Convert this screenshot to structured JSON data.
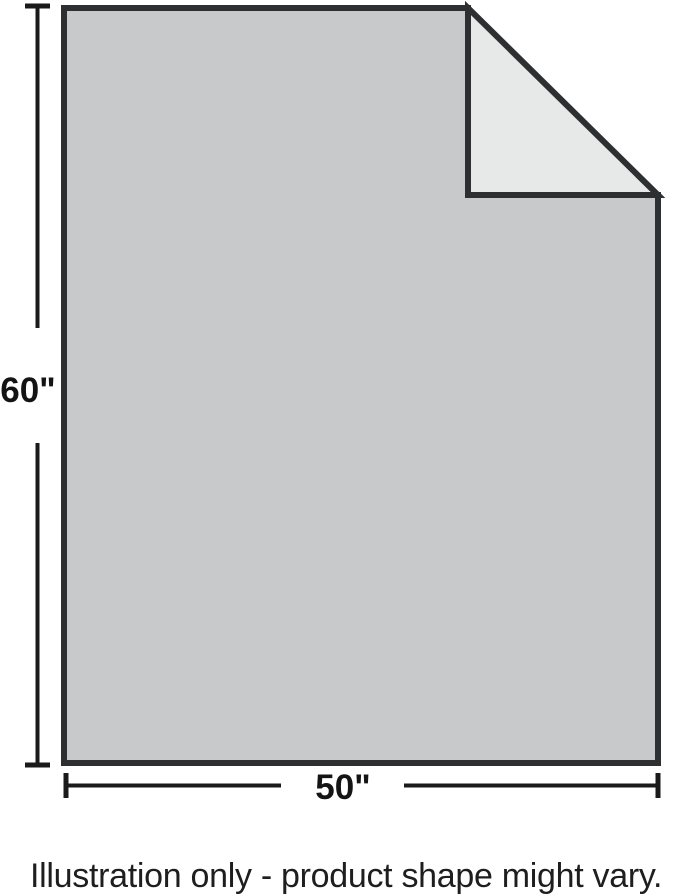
{
  "illustration": {
    "height_label": "60\"",
    "width_label": "50\"",
    "caption": "Illustration only - product shape might vary.",
    "colors": {
      "body_fill": "#c7c9cb",
      "fold_fill": "#e7e8e8",
      "outline": "#2e2f31",
      "dimension": "#1a1a1a",
      "label_text": "#141414",
      "caption_text": "#1e1e1e",
      "background": "#ffffff"
    }
  }
}
